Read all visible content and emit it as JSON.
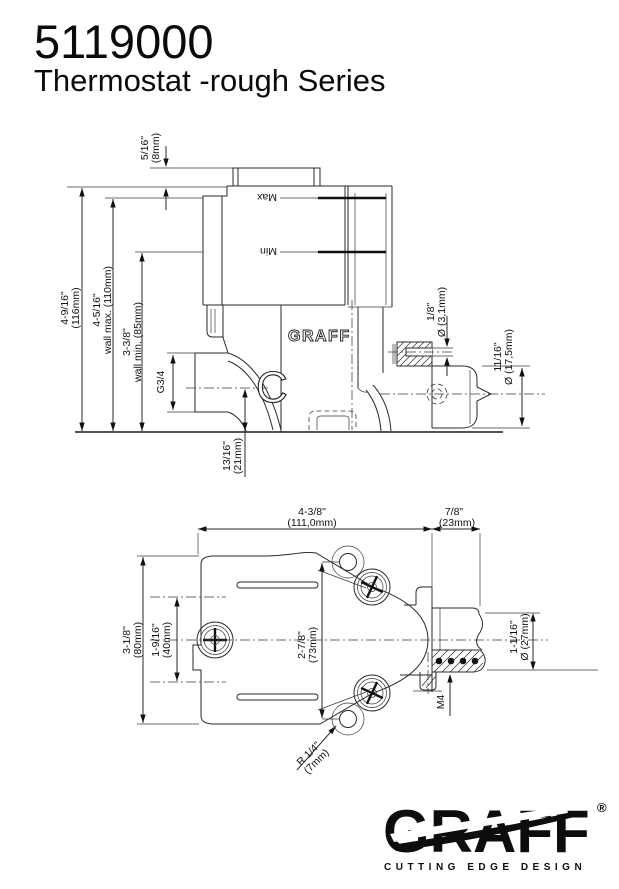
{
  "header": {
    "product_code": "5119000",
    "series_title": "Thermostat -rough Series"
  },
  "side_view": {
    "dim_plate": {
      "in": "5/16\"",
      "mm": "(8mm)"
    },
    "dim_total": {
      "in": "4-9/16\"",
      "mm": "(116mm)"
    },
    "dim_wall_max": {
      "in": "4-5/16\"",
      "mm": "wall max. (110mm)"
    },
    "dim_wall_min": {
      "in": "3-3/8\"",
      "mm": "wall min. (85mm)"
    },
    "label_max": "Max",
    "label_min": "Min",
    "thread_label": "G3/4",
    "body_letter": "C",
    "body_brand": "GRAFF",
    "dim_hole": {
      "in": "1/8\"",
      "mm": "Ø (3,1mm)"
    },
    "dim_cartridge": {
      "in": "11/16\"",
      "mm": "Ø (17,5mm)"
    },
    "dim_center_offset": {
      "in": "13/16\"",
      "mm": "(21mm)"
    }
  },
  "plan_view": {
    "dim_width": {
      "in": "4-3/8\"",
      "mm": "(111,0mm)"
    },
    "dim_outlet": {
      "in": "7/8\"",
      "mm": "(23mm)"
    },
    "dim_height": {
      "in": "3-1/8\"",
      "mm": "(80mm)"
    },
    "dim_holes_v": {
      "in": "1-9/16\"",
      "mm": "(40mm)"
    },
    "dim_screws_v": {
      "in": "2-7/8\"",
      "mm": "(73mm)"
    },
    "dim_outlet_dia": {
      "in": "1-1/16\"",
      "mm": "Ø (27mm)"
    },
    "thread_label": "M4",
    "dim_radius": {
      "in": "R 1/4\"",
      "mm": "(7mm)"
    }
  },
  "logo": {
    "brand": "GRAFF",
    "registered": "®",
    "tagline": "CUTTING EDGE DESIGN"
  },
  "colors": {
    "ink": "#111111",
    "paper": "#ffffff"
  }
}
